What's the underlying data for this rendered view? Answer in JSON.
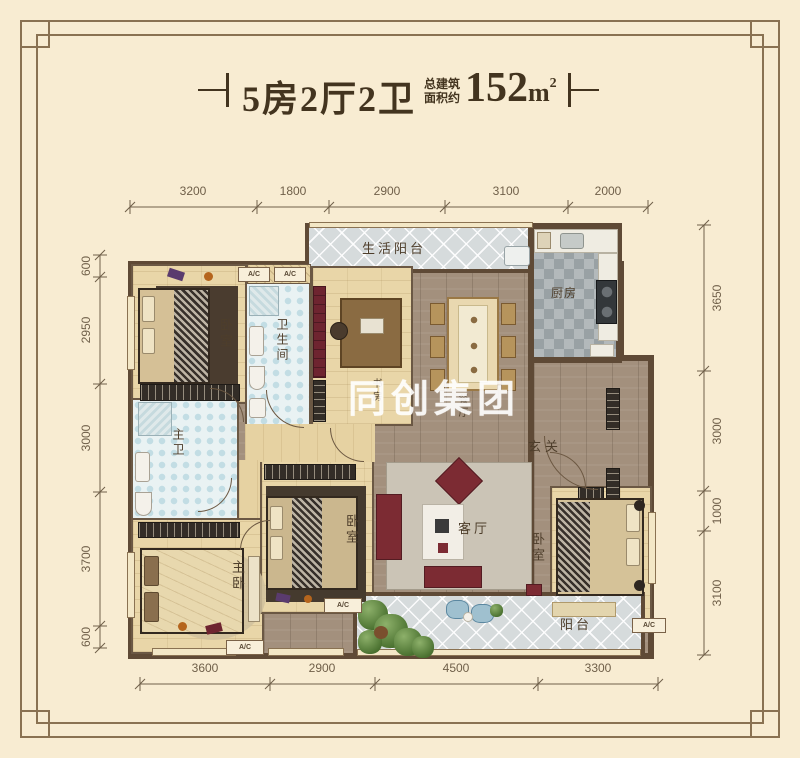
{
  "title": {
    "layout": "5房2厅2卫",
    "area_label_line1": "总建筑",
    "area_label_line2": "面积约",
    "area_number": "152",
    "area_unit": "m",
    "area_sup": "2"
  },
  "watermark": "同创集团",
  "dimensions": {
    "top": [
      "3200",
      "1800",
      "2900",
      "3100",
      "2000"
    ],
    "left": [
      "600",
      "2950",
      "3000",
      "3700",
      "600"
    ],
    "right": [
      "3650",
      "3000",
      "1000",
      "3100"
    ],
    "bottom": [
      "3600",
      "2900",
      "4500",
      "3300"
    ]
  },
  "rooms": {
    "living_balcony": "生活阳台",
    "kitchen": "厨房",
    "bedroom_top_left": "卧室",
    "bathroom": "卫生间",
    "study": "书房",
    "dining": "餐厅",
    "foyer": "玄关",
    "living_room": "客厅",
    "master_bath": "主卫",
    "master_bedroom": "主卧",
    "bedroom_middle": "卧室",
    "bedroom_right": "卧室",
    "balcony": "阳台"
  },
  "labels": {
    "ac": "A/C"
  },
  "colors": {
    "background": "#f8ecd2",
    "frame": "#8a7252",
    "title_text": "#43341f",
    "wall": "#5f4a36",
    "wood_floor": "#e9d6a8",
    "walnut_floor": "#a3907d",
    "balcony_tile": "#d6dbdc",
    "bath_tile": "#e9f2f3",
    "kitchen_tile": "#b3b9bb",
    "accent_red": "#7c2b33",
    "watermark_white": "#ffffff"
  }
}
